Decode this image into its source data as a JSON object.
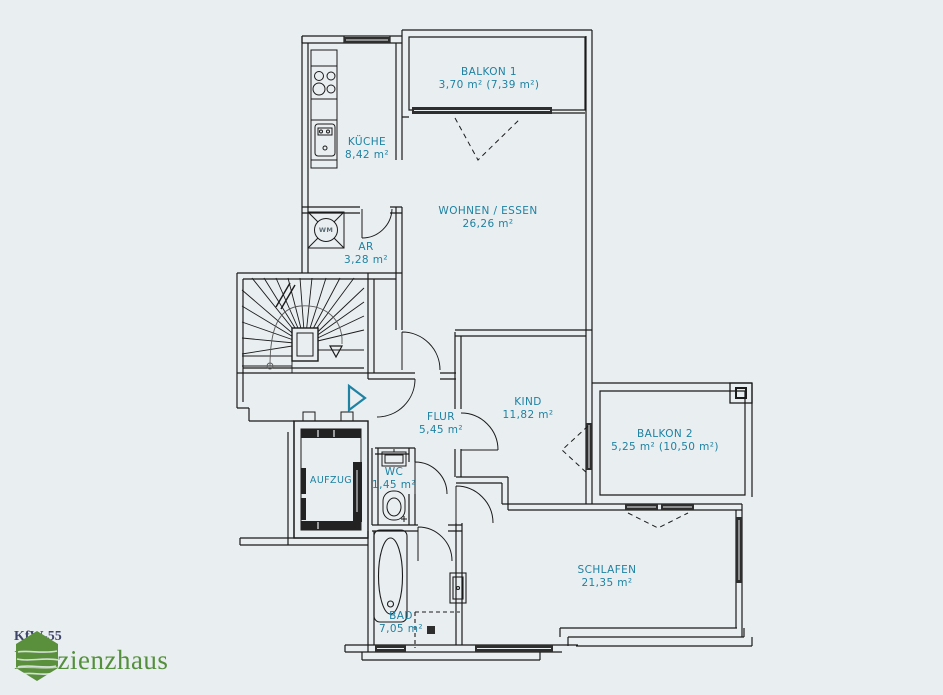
{
  "meta": {
    "background_color": "#e9eef1",
    "wall_color": "#1b1b1b",
    "label_color": "#1e82a2"
  },
  "rooms": {
    "balkon1": {
      "name": "BALKON 1",
      "area": "3,70 m² (7,39 m²)"
    },
    "kueche": {
      "name": "KÜCHE",
      "area": "8,42 m²"
    },
    "wohnen": {
      "name": "WOHNEN / ESSEN",
      "area": "26,26 m²"
    },
    "ar": {
      "name": "AR",
      "area": "3,28 m²"
    },
    "flur": {
      "name": "FLUR",
      "area": "5,45 m²"
    },
    "kind": {
      "name": "KIND",
      "area": "11,82 m²"
    },
    "balkon2": {
      "name": "BALKON 2",
      "area": "5,25 m² (10,50 m²)"
    },
    "aufzug": {
      "name": "AUFZUG"
    },
    "wc": {
      "name": "WC",
      "area": "1,45 m²"
    },
    "bad": {
      "name": "BAD",
      "area": "7,05 m²"
    },
    "schlafen": {
      "name": "SCHLAFEN",
      "area": "21,35 m²"
    }
  },
  "fixtures": {
    "washing_machine": "WM"
  },
  "logo": {
    "line1": "KfW-55",
    "line2": "Effizienzhaus",
    "green": "#54903c",
    "navy": "#3e4569"
  }
}
